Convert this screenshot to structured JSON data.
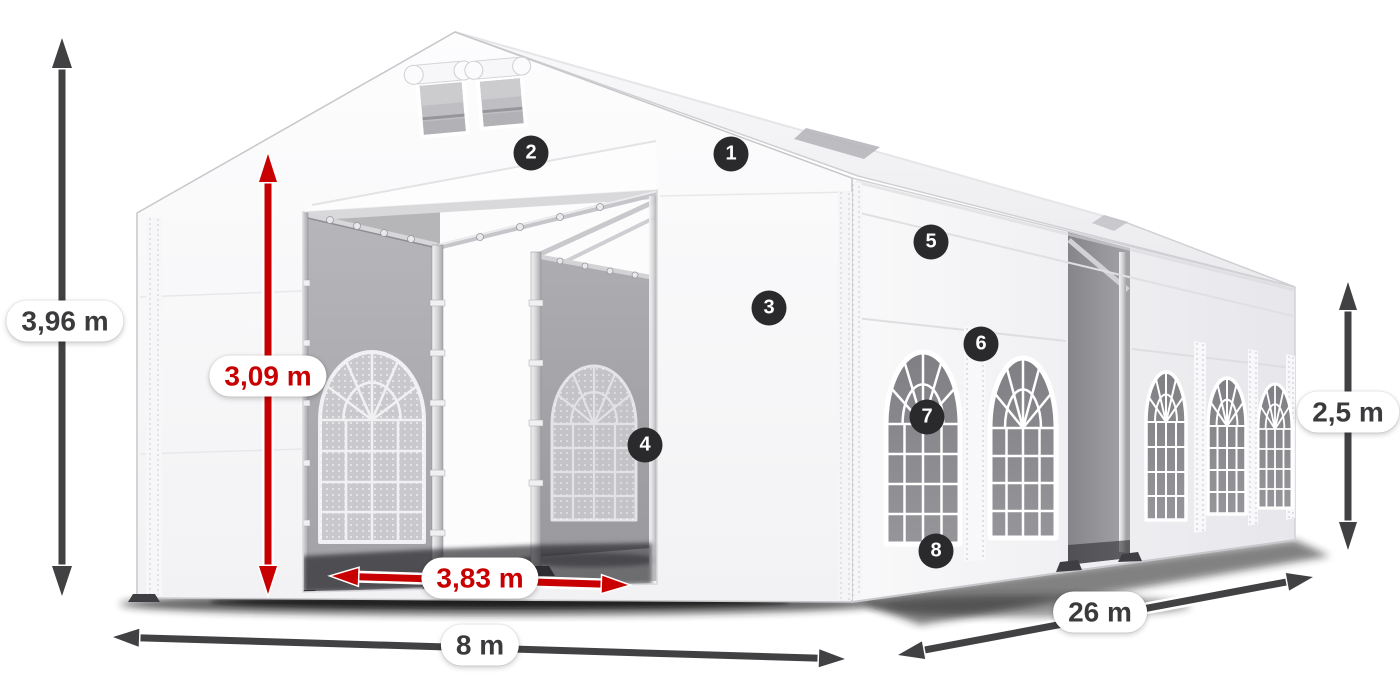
{
  "diagram": {
    "subject": "White marquee party tent with open front entrance, dimension arrows and numbered feature callouts",
    "dimensions": {
      "total_height": {
        "label": "3,96 m",
        "style": "dark"
      },
      "entrance_height": {
        "label": "3,09 m",
        "style": "red"
      },
      "entrance_width": {
        "label": "3,83 m",
        "style": "red"
      },
      "front_width": {
        "label": "8 m",
        "style": "dark"
      },
      "side_length": {
        "label": "26 m",
        "style": "dark"
      },
      "wall_height": {
        "label": "2,5 m",
        "style": "dark"
      }
    },
    "callouts": [
      {
        "number": "1"
      },
      {
        "number": "2"
      },
      {
        "number": "3"
      },
      {
        "number": "4"
      },
      {
        "number": "5"
      },
      {
        "number": "6"
      },
      {
        "number": "7"
      },
      {
        "number": "8"
      }
    ],
    "colors": {
      "dimension_dark": "#414144",
      "dimension_red": "#c80001",
      "badge_background": "#2a2a2d",
      "badge_text": "#ffffff",
      "label_text": "#3b3b3d",
      "label_background": "#ffffff"
    }
  }
}
